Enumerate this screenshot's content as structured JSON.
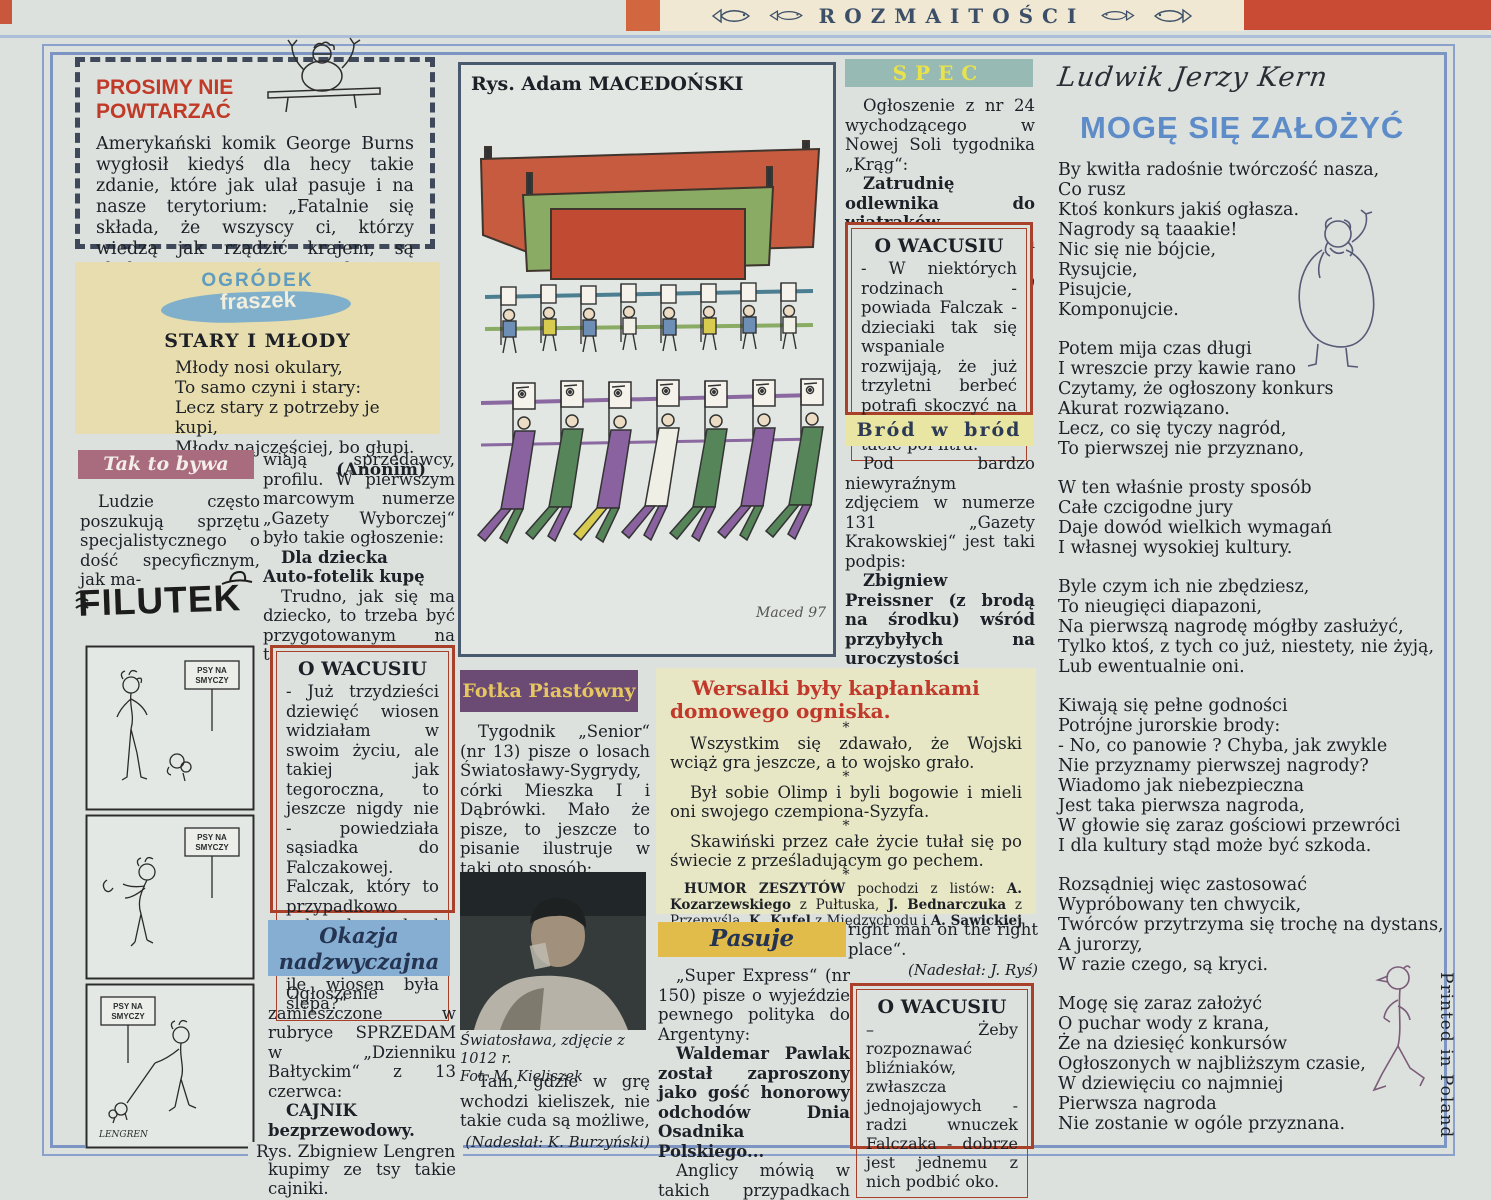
{
  "header": {
    "title": "ROZMAITOŚCI"
  },
  "edge": {
    "printed": "Printed in Poland",
    "bottom_credit": "Rys. Zbigniew Lengren"
  },
  "prosimy": {
    "title": "PROSIMY NIE\nPOWTARZAĆ",
    "body": "Amerykański komik George Burns wygłosił kiedyś dla hecy takie zdanie, które jak ulał pasuje i na nasze terytorium: „Fatalnie się składa, że wszyscy ci, którzy wiedzą jak rządzić krajem, są cholernie zajęci prowadzeniem taksówek i strzyżeniem włosów“."
  },
  "fraszka": {
    "logo_top": "OGRÓDEK",
    "logo_bottom": "fraszek",
    "title": "STARY I MŁODY",
    "poem": "Młody nosi okulary,\nTo samo czyni i stary:\nLecz stary z potrzeby je kupi,\nMłody najczęściej, bo głupi.",
    "author": "(Anonim)"
  },
  "tak_to_bywa": {
    "header": "Tak to bywa",
    "intro": "Ludzie często poszukują sprzętu specjalistycznego o dość specyficznym, jak ma-"
  },
  "ogloszenie_cd": {
    "p1": "wiają sprzedawcy, profilu. W pierwszym marcowym numerze „Gazety Wyborczej“ było takie ogłoszenie:",
    "bold": "Dla dziecka\nAuto-fotelik kupę",
    "p2": "Trudno, jak się ma dziecko, to trzeba być przygotowanym na taką ewentualność.",
    "credit": "(Nadesłała: M. Kowalczyk)"
  },
  "filutek": {
    "logo": "FILUTEK",
    "sign": "PSY NA\nSMYCZY",
    "signature": "LENGREN"
  },
  "wacusiu1": {
    "title": "O WACUSIU",
    "body": "- Już trzydzieści dziewięć wiosen widziałam w swoim życiu, ale takiej jak tegoroczna, to jeszcze nigdy nie - powiedziała sąsiadka do Falczakowej. Falczak, który to przypadkowo usłyszał, mruknął pod nosem „Ciekaw jestem, ile wiosen była ślepa?“"
  },
  "okazja": {
    "header": "Okazja\nnadzwyczajna",
    "p1": "Ogłoszenie zamieszczone w rubryce SPRZEDAM w „Dzienniku Bałtyckim“ z 13 czerwca:",
    "bold": "CAJNIK bezprzewodowy.",
    "p2": "Sarpniemy się i kupimy ze tsy takie cajniki.",
    "credit": "(Nadesłała: H. Grzesiak)"
  },
  "macedonski": {
    "title": "Rys. Adam MACEDOŃSKI",
    "signature": "Maced 97."
  },
  "fotka": {
    "header": "Fotka Piastówny",
    "p1": "Tygodnik „Senior“ (nr 13) pisze o losach Światosławy-Sygrydy, córki Mieszka I i Dąbrówki. Mało że pisze, to jeszcze to pisanie ilustruje w taki oto sposób:",
    "caption": "Światosława, zdjęcie z 1012 r.\nFot. M. Kieliszek",
    "p2": "Tam, gdzie w grę wchodzi kieliszek, nie takie cuda są możliwe,",
    "credit": "(Nadesłał: K. Burzyński)"
  },
  "spec": {
    "header": "SPEC",
    "p1": "Ogłoszenie z nr 24 wychodzącego w Nowej Soli tygodnika „Krąg“:",
    "bold": "Zatrudnię odlewnika do wiatraków.",
    "p2": "Czy może być Don Kichot?",
    "credit": "(Nadesłał: Z. Herman)"
  },
  "wacusiu2": {
    "title": "O WACUSIU",
    "body": "- W niektórych rodzinach - powiada Falczak - dzieciaki tak się wspaniale rozwijają, że już trzyletni berbeć potrafi skoczyć na melinę i przynieść tacie pół litra."
  },
  "brod": {
    "header": "Bród w bród",
    "p1": "Pod bardzo niewyraźnym zdjęciem w numerze 131 „Gazety Krakowskiej“ jest taki podpis:",
    "bold": "Zbigniew Preissner (z brodą na środku) wśród przybyłych na uroczystości",
    "p2": "Do pełnego uwłosienia przydałby się jeszcze ktoś (z brodą na prawo) i ktoś inny (z brodą na lewo).",
    "credit": "(Nadesłała: D. Sopata)"
  },
  "wersalki": {
    "title": "Wersalki były kapłankami domowego ogniska.",
    "sep": "*",
    "p1": "Wszystkim się zdawało, że Wojski wciąż gra jeszcze, a to wojsko grało.",
    "p2": "Był sobie Olimp i byli bogowie i mieli oni swojego czempiona-Syzyfa.",
    "p3": "Skawiński przez całe życie tułał się po świecie z prześladującym go pechem.",
    "credit_segments": [
      {
        "t": "HUMOR ZESZYTÓW"
      },
      {
        "t": " pochodzi z listów: "
      },
      {
        "t": "A. Kozarzewskiego"
      },
      {
        "t": " z Pułtuska, "
      },
      {
        "t": "J. Bednarczuka"
      },
      {
        "t": " z Przemyśla, "
      },
      {
        "t": "K. Kufel"
      },
      {
        "t": " z Międzychodu i "
      },
      {
        "t": "A. Sawickiej"
      },
      {
        "t": " z Łodzi. Dziękujemy."
      }
    ]
  },
  "pasuje": {
    "header": "Pasuje",
    "p1": "„Super Express“ (nr 150) pisze o wyjeździe pewnego polityka do Argentyny:",
    "bold": "Waldemar Pawlak został zaproszony jako gość honorowy odchodów Dnia Osadnika Polskiego...",
    "p2": "Anglicy mówią w takich przypadkach „The"
  },
  "rightman": {
    "p": "right man on the right place“.",
    "credit": "(Nadesłał: J. Ryś)"
  },
  "wacusiu3": {
    "title": "O WACUSIU",
    "body": "– Żeby rozpoznawać bliźniaków, zwłaszcza jednojajowych - radzi wnuczek Falczaka - dobrze jest jednemu z nich podbić oko."
  },
  "kern": {
    "author": "Ludwik Jerzy Kern",
    "title": "MOGĘ SIĘ ZAŁOŻYĆ",
    "stanzas": [
      "By kwitła radośnie twórczość nasza,\nCo rusz\nKtoś konkurs jakiś ogłasza.\nNagrody są taaakie!\nNic się nie bójcie,\nRysujcie,\nPisujcie,\nKomponujcie.",
      "Potem mija czas długi\nI wreszcie przy kawie rano\nCzytamy, że ogłoszony konkurs\nAkurat rozwiązano.\nLecz, co się tyczy nagród,\nTo pierwszej nie przyznano,",
      "W ten właśnie prosty sposób\nCałe czcigodne jury\nDaje dowód wielkich wymagań\nI własnej wysokiej  kultury.",
      "Byle czym ich nie zbędziesz,\nTo nieugięci diapazoni,\nNa pierwszą nagrodę mógłby  zasłużyć,\nTylko ktoś, z tych co już, niestety, nie żyją,\nLub ewentualnie oni.",
      "Kiwają się pełne godności\nPotrójne jurorskie brody:\n- No, co panowie ? Chyba, jak zwykle\nNie przyznamy pierwszej nagrody?\nWiadomo jak niebezpieczna\nJest taka pierwsza nagroda,\nW głowie się zaraz gościowi przewróci\nI dla kultury stąd  może być szkoda.",
      "Rozsądniej więc zastosować\nWypróbowany ten chwycik,\nTwórców przytrzyma się trochę na dystans,\nA jurorzy,\nW razie czego, są kryci.",
      "Mogę się  zaraz założyć\nO puchar wody z krana,\nŻe na dziesięć konkursów\nOgłoszonych  w najbliższym czasie,\nW dziewięciu co najmniej\nPierwsza nagroda\nNie  zostanie w ogóle przyznana."
    ]
  }
}
